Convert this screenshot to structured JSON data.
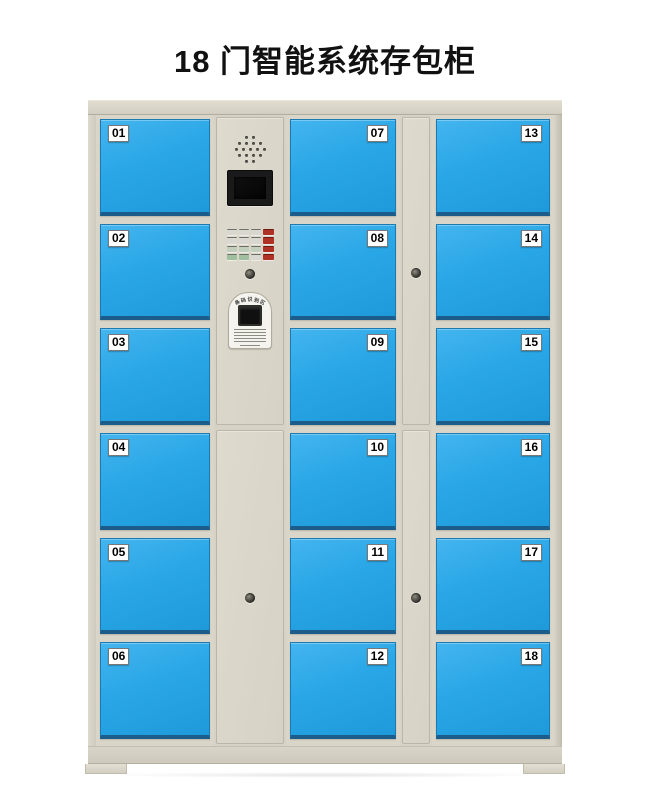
{
  "title": "18 门智能系统存包柜",
  "colors": {
    "door_blue": "#29a6e6",
    "frame_beige": "#d9d5c8",
    "keypad_red": "#b03226",
    "keypad_green": "#9fbf9f"
  },
  "cabinet": {
    "doors": {
      "left": [
        "01",
        "02",
        "03",
        "04",
        "05",
        "06"
      ],
      "middle": [
        "07",
        "08",
        "09",
        "10",
        "11",
        "12"
      ],
      "right": [
        "13",
        "14",
        "15",
        "16",
        "17",
        "18"
      ]
    },
    "control_panel": {
      "speaker_icon": "speaker-grille-icon",
      "screen_icon": "display-screen",
      "keypad": {
        "rows": 4,
        "cols": 4
      },
      "keyhole_icon": "keyhole-icon",
      "scanner": {
        "label": "条码识别区",
        "window_icon": "scanner-window"
      }
    },
    "lock_stile_keyholes": 2
  }
}
